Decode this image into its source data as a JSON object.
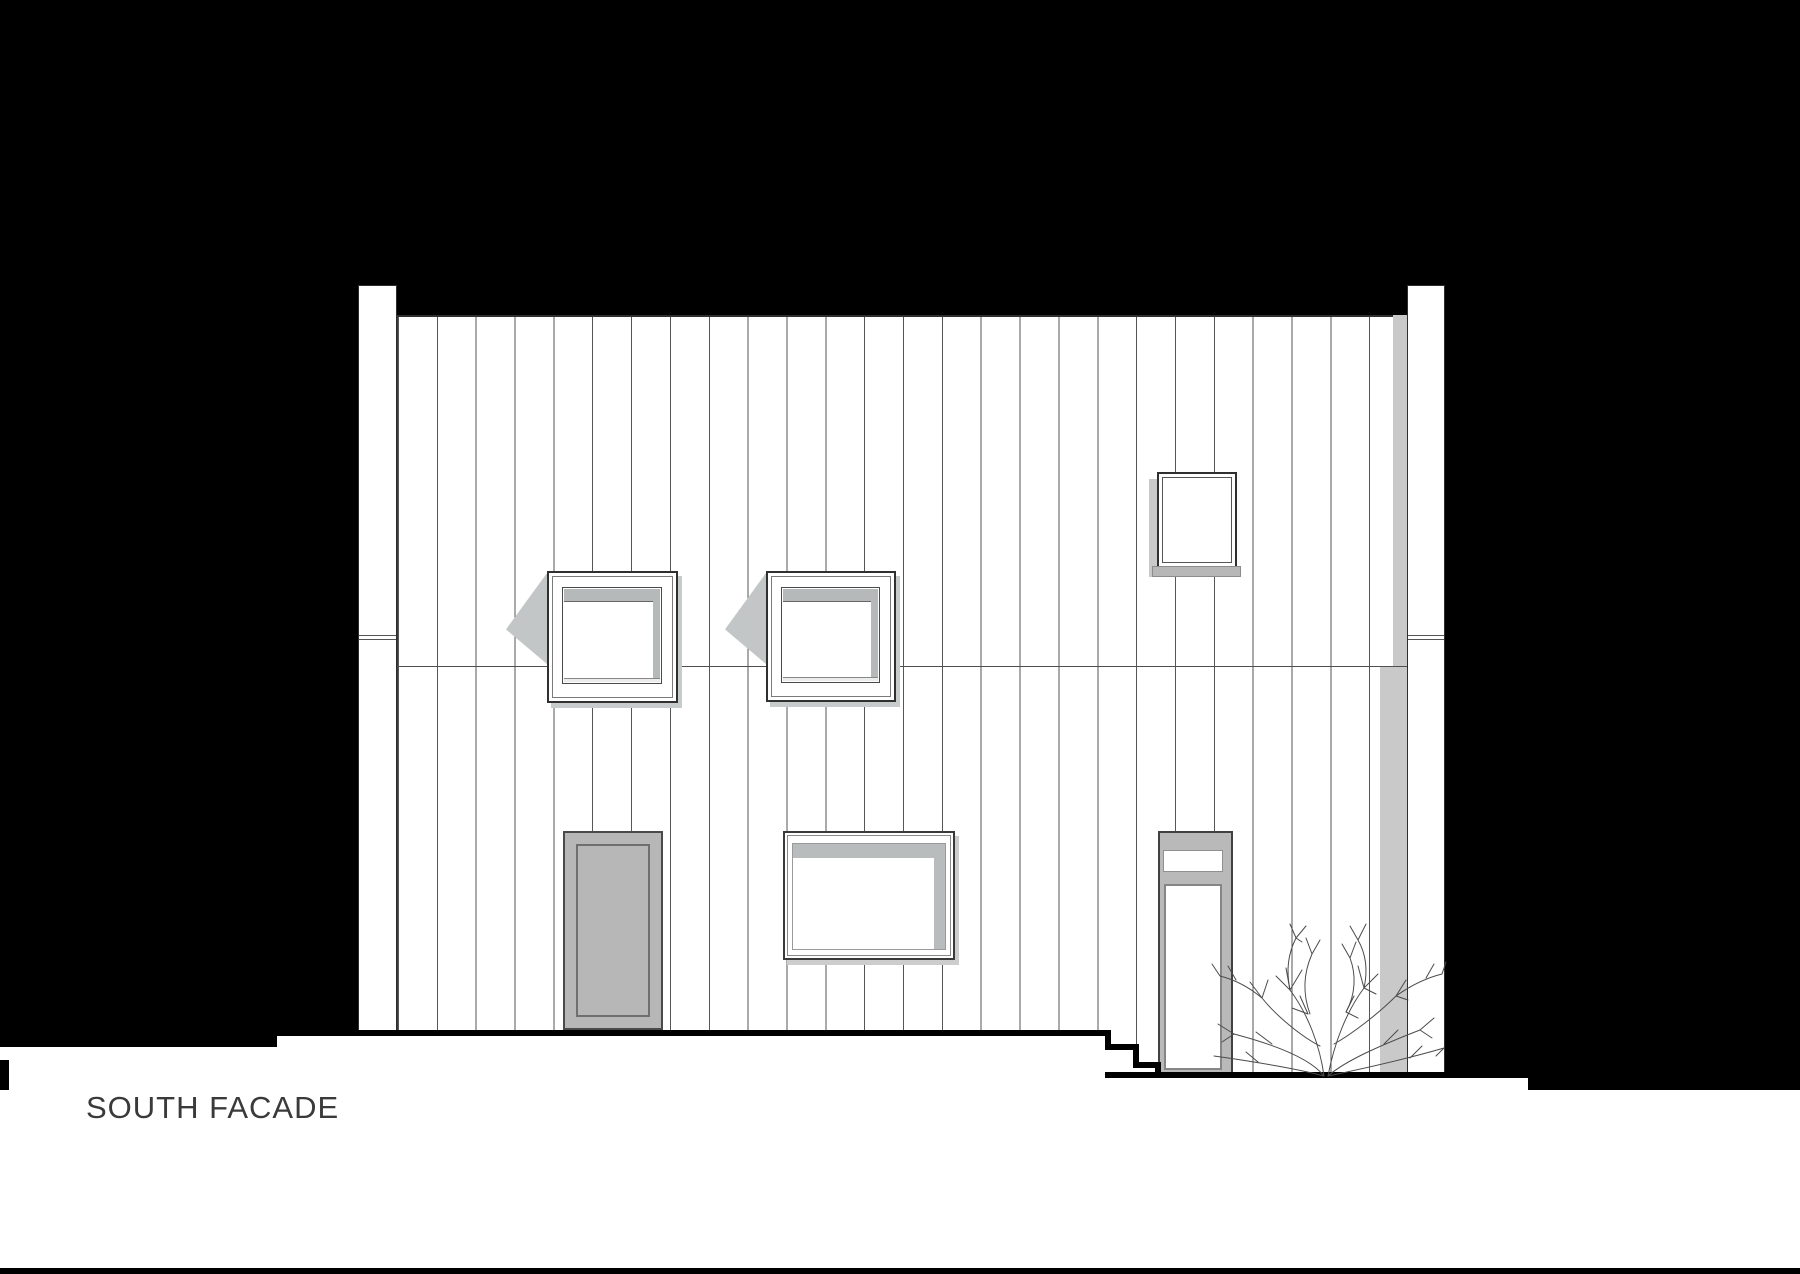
{
  "title": {
    "label": "SOUTH FACADE"
  },
  "palette": {
    "background": "#000000",
    "wall": "#ffffff",
    "drawing_line": "#4a4a4a",
    "shadow_gray": "#c6c8c8",
    "door_gray": "#b7b7b7",
    "title_text": "#3a3a3a"
  }
}
